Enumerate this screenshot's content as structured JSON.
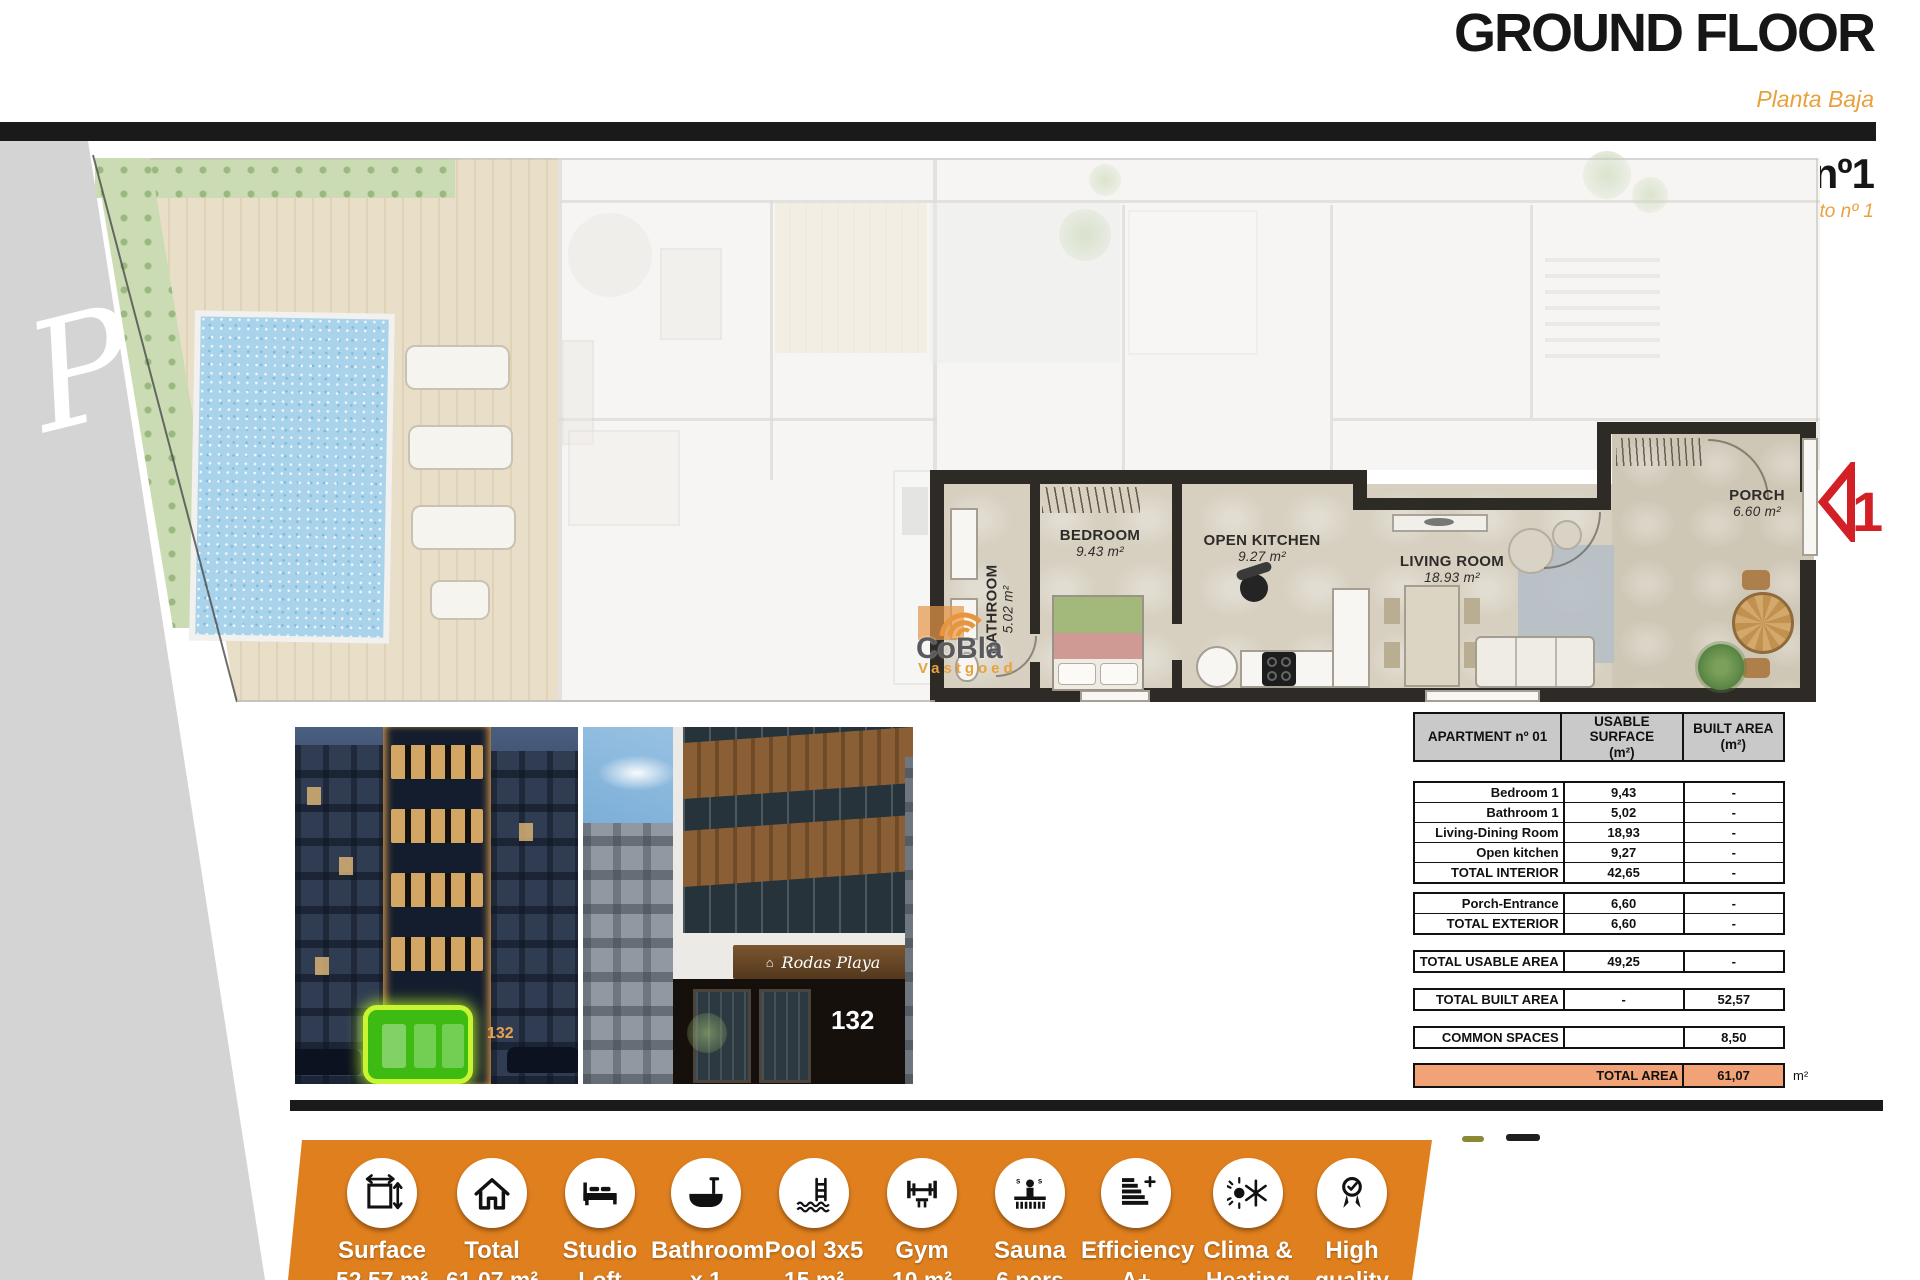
{
  "header": {
    "title": "GROUND FLOOR",
    "subtitle": "Planta Baja",
    "apartment_title": "Apartment nº1",
    "apartment_subtitle": "Apartamento nº 1"
  },
  "watermarks": {
    "page_script": "Pl",
    "logo_name": "CoBla",
    "logo_tagline": "Vastgoed"
  },
  "floorplan": {
    "marker_number": "1",
    "rooms": {
      "bathroom": {
        "label": "BATHROOM",
        "area": "5.02 m²"
      },
      "bedroom": {
        "label": "BEDROOM",
        "area": "9.43 m²"
      },
      "kitchen": {
        "label": "OPEN KITCHEN",
        "area": "9.27 m²"
      },
      "living": {
        "label": "LIVING ROOM",
        "area": "18.93 m²"
      },
      "porch": {
        "label": "PORCH",
        "area": "6.60 m²"
      }
    }
  },
  "table": {
    "header": {
      "col1": "APARTMENT nº 01",
      "col2a": "USABLE SURFACE",
      "col2b": "(m²)",
      "col3a": "BUILT AREA",
      "col3b": "(m²)"
    },
    "g1": [
      [
        "Bedroom 1",
        "9,43",
        "-"
      ],
      [
        "Bathroom 1",
        "5,02",
        "-"
      ],
      [
        "Living-Dining Room",
        "18,93",
        "-"
      ],
      [
        "Open kitchen",
        "9,27",
        "-"
      ],
      [
        "TOTAL INTERIOR",
        "42,65",
        "-"
      ]
    ],
    "g2": [
      [
        "Porch-Entrance",
        "6,60",
        "-"
      ],
      [
        "TOTAL EXTERIOR",
        "6,60",
        "-"
      ]
    ],
    "g3": [
      [
        "TOTAL USABLE AREA",
        "49,25",
        "-"
      ]
    ],
    "g4": [
      [
        "TOTAL BUILT AREA",
        "-",
        "52,57"
      ]
    ],
    "g5": [
      [
        "COMMON SPACES",
        "",
        "8,50"
      ]
    ],
    "total": {
      "label": "TOTAL AREA",
      "value": "61,07",
      "unit": "m²"
    }
  },
  "photos": {
    "left": {
      "street_number": "132"
    },
    "right": {
      "sign": "Rodas Playa",
      "street_number": "132"
    }
  },
  "amenities": [
    {
      "line1": "Surface",
      "line2": "52.57 m²"
    },
    {
      "line1": "Total",
      "line2": "61.07 m²"
    },
    {
      "line1": "Studio",
      "line2": "Loft"
    },
    {
      "line1": "Bathroom",
      "line2": "x 1"
    },
    {
      "line1": "Pool 3x5",
      "line2": "15 m²"
    },
    {
      "line1": "Gym",
      "line2": "10 m²"
    },
    {
      "line1": "Sauna",
      "line2": "6 pers"
    },
    {
      "line1": "Efficiency",
      "line2": "A+"
    },
    {
      "line1": "Clima &",
      "line2": "Heating"
    },
    {
      "line1": "High",
      "line2": "quality"
    }
  ],
  "colors": {
    "accent_orange": "#df7f1e",
    "light_orange": "#e8a13c",
    "table_total_fill": "#f1a377",
    "marker_red": "#d31f26",
    "highlight_green": "#3dbb12"
  }
}
